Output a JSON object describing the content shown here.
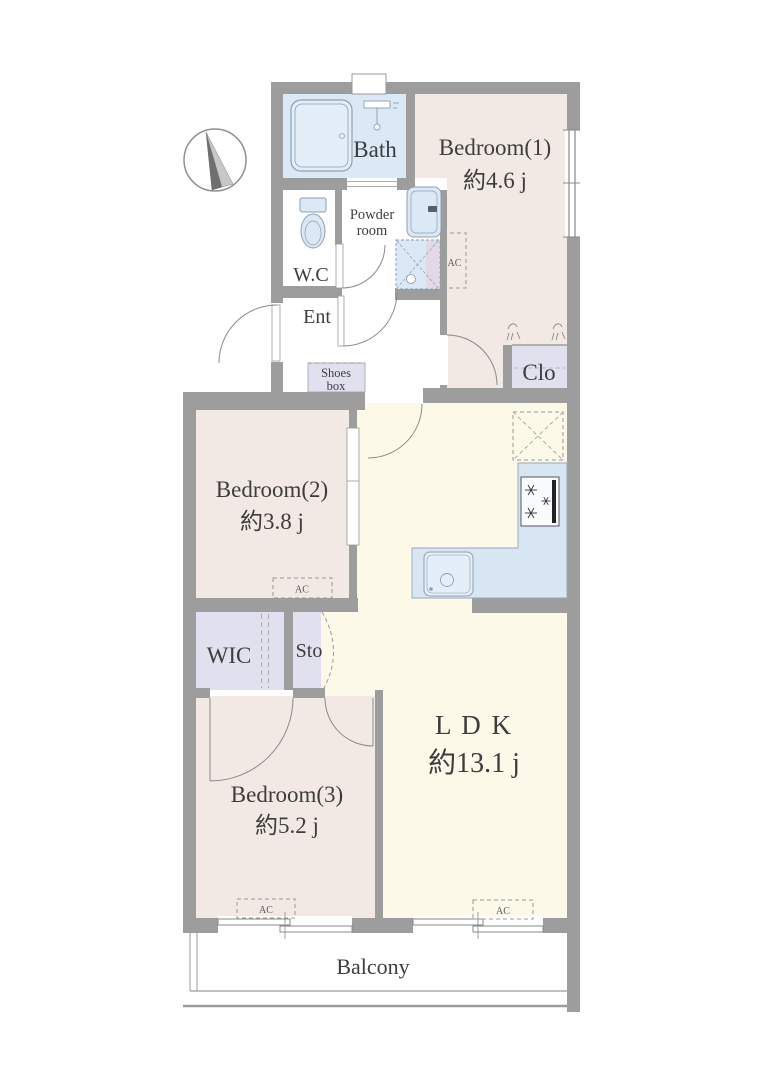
{
  "page": {
    "type": "apartment-floor-plan",
    "width_px": 768,
    "height_px": 1087,
    "background": "#ffffff"
  },
  "colors": {
    "wall": "#9d9d9d",
    "bedroom_fill": "#f2e9e4",
    "ldk_fill": "#fcf9e9",
    "water_fill": "#dbe8f5",
    "counter_fill": "#d8e6f3",
    "storage_fill": "#e1e0ee",
    "washer_accent_fill": "#e3d8e8",
    "fixture_line": "#8fa0b0",
    "text": "#3d3d3d"
  },
  "rooms": {
    "bath": {
      "label": "Bath"
    },
    "bedroom1": {
      "label": "Bedroom(1)",
      "area": "約4.6 j"
    },
    "powder_room": {
      "line1": "Powder",
      "line2": "room"
    },
    "wc": {
      "label": "W.C"
    },
    "ent": {
      "label": "Ent"
    },
    "shoes_box": {
      "line1": "Shoes",
      "line2": "box"
    },
    "closet": {
      "label": "Clo"
    },
    "bedroom2": {
      "label": "Bedroom(2)",
      "area": "約3.8 j"
    },
    "wic": {
      "label": "WIC"
    },
    "storage": {
      "label": "Sto"
    },
    "bedroom3": {
      "label": "Bedroom(3)",
      "area": "約5.2 j"
    },
    "ldk": {
      "label": "L D K",
      "area": "約13.1 j"
    },
    "balcony": {
      "label": "Balcony"
    }
  },
  "markers": {
    "ac_label": "AC"
  },
  "icons": [
    "compass-icon",
    "bathtub-icon",
    "shower-icon",
    "toilet-icon",
    "vanity-sink-icon",
    "washing-machine-pan-icon",
    "refrigerator-space-icon",
    "stove-icon",
    "kitchen-sink-icon",
    "hanger-pipe-icon"
  ]
}
